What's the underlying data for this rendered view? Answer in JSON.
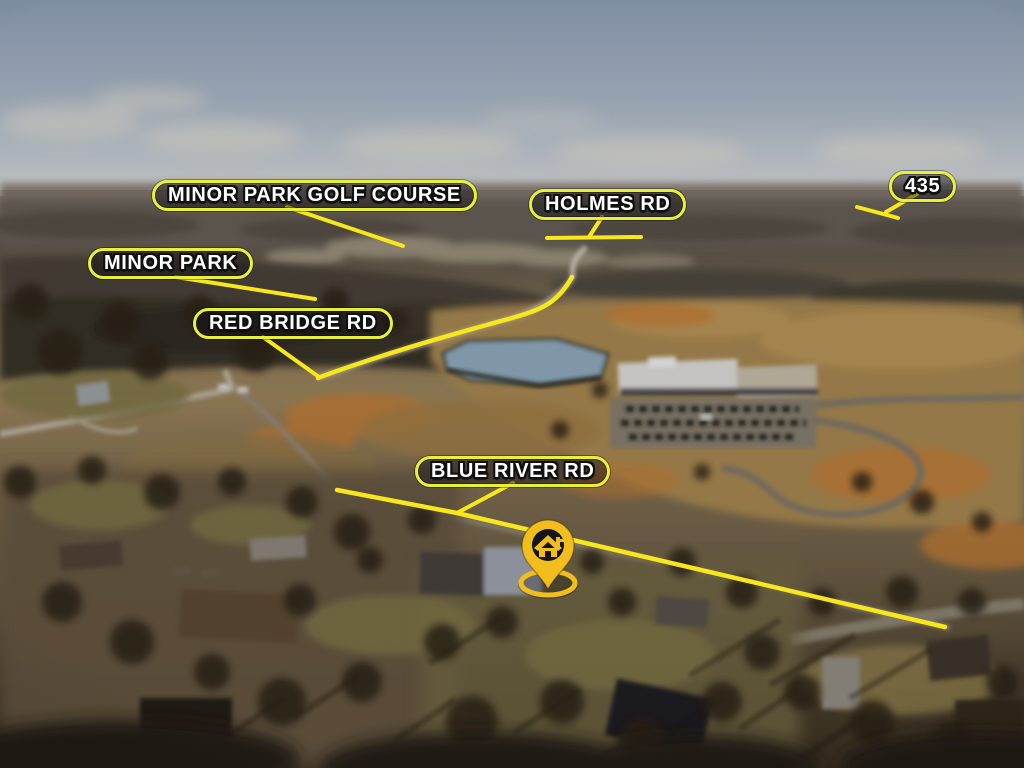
{
  "annotations": {
    "labels": [
      {
        "id": "minor-park-golf-course",
        "text": "MINOR PARK GOLF COURSE"
      },
      {
        "id": "holmes-rd",
        "text": "HOLMES RD"
      },
      {
        "id": "highway-435",
        "text": "435"
      },
      {
        "id": "minor-park",
        "text": "MINOR PARK"
      },
      {
        "id": "red-bridge-rd",
        "text": "RED BRIDGE RD"
      },
      {
        "id": "blue-river-rd",
        "text": "BLUE RIVER RD"
      }
    ],
    "marker": {
      "type": "property-location-pin",
      "icon": "house-icon"
    },
    "colors": {
      "line_yellow": "#F8E71A",
      "pill_border": "#E9F136",
      "label_text": "#FFFFFF",
      "pin_yellow": "#F1BE1E",
      "pin_inner_dark": "#15161D"
    }
  },
  "scene": {
    "type": "aerial-drone-photo",
    "visible_features": [
      "overcast blue-gray sky",
      "distant treeline horizon",
      "golf course clearing",
      "pond",
      "office building with parking lot",
      "winding roads",
      "open tan fields",
      "residential neighborhood with bare winter trees"
    ]
  }
}
